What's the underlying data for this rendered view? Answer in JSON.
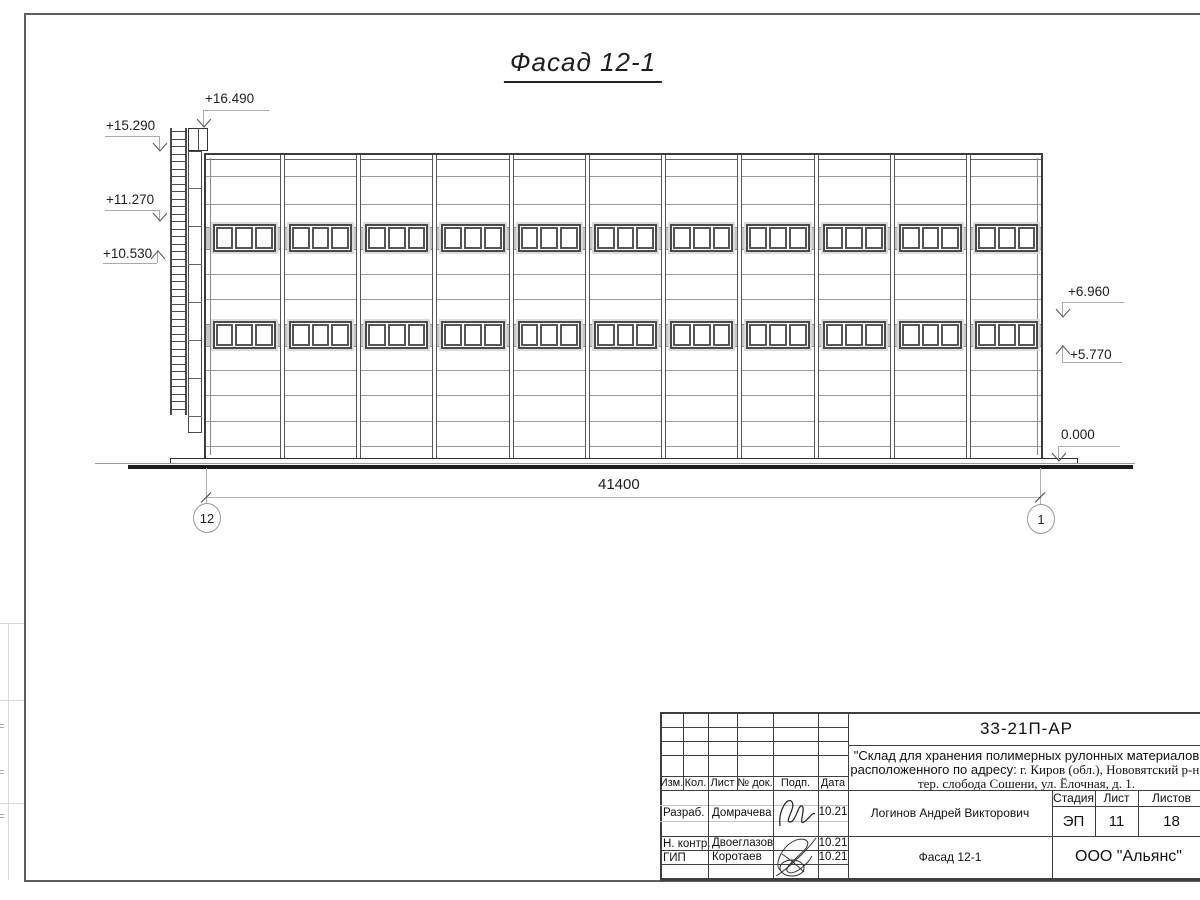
{
  "sheet": {
    "title": "Фасад 12-1"
  },
  "drawing": {
    "elevation_marks": [
      "+16.490",
      "+15.290",
      "+11.270",
      "+10.530",
      "+6.960",
      "+5.770",
      "0.000"
    ],
    "dimension_total": "41400",
    "axis_left": "12",
    "axis_right": "1",
    "bays": 11,
    "window_rows": 2,
    "window_panes": 3
  },
  "title_block": {
    "doc_number": "33-21П-АР",
    "project_line1": "\"Склад для хранения полимерных рулонных материалов",
    "project_line2_sans": "расположенного по адресу:",
    "project_line2_serif": " г. Киров (обл.), Нововятский р-н,",
    "project_line3": "тер. слобода Сошени, ул. Ёлочная, д. 1.",
    "rev_headers": [
      "Изм.",
      "Кол.",
      "Лист",
      "№ док.",
      "Подп.",
      "Дата"
    ],
    "stage_header": "Стадия",
    "sheet_header": "Лист",
    "sheets_header": "Листов",
    "stage": "ЭП",
    "sheet_no": "11",
    "sheets_total": "18",
    "roles": [
      {
        "role": "Разраб.",
        "name": "Домрачева",
        "date": "10.21"
      },
      {
        "role": "Н. контр.",
        "name": "Двоеглазов",
        "date": "10.21"
      },
      {
        "role": "ГИП",
        "name": "Коротаев",
        "date": "10.21"
      }
    ],
    "chief_name": "Логинов Андрей Викторович",
    "drawing_name": "Фасад 12-1",
    "company": "ООО \"Альянс\""
  },
  "colors": {
    "line_dark": "#3c3c3c",
    "line_light": "#9a9a9a",
    "band_gray": "#c6c6c6",
    "ground_black": "#1b1b1b"
  }
}
